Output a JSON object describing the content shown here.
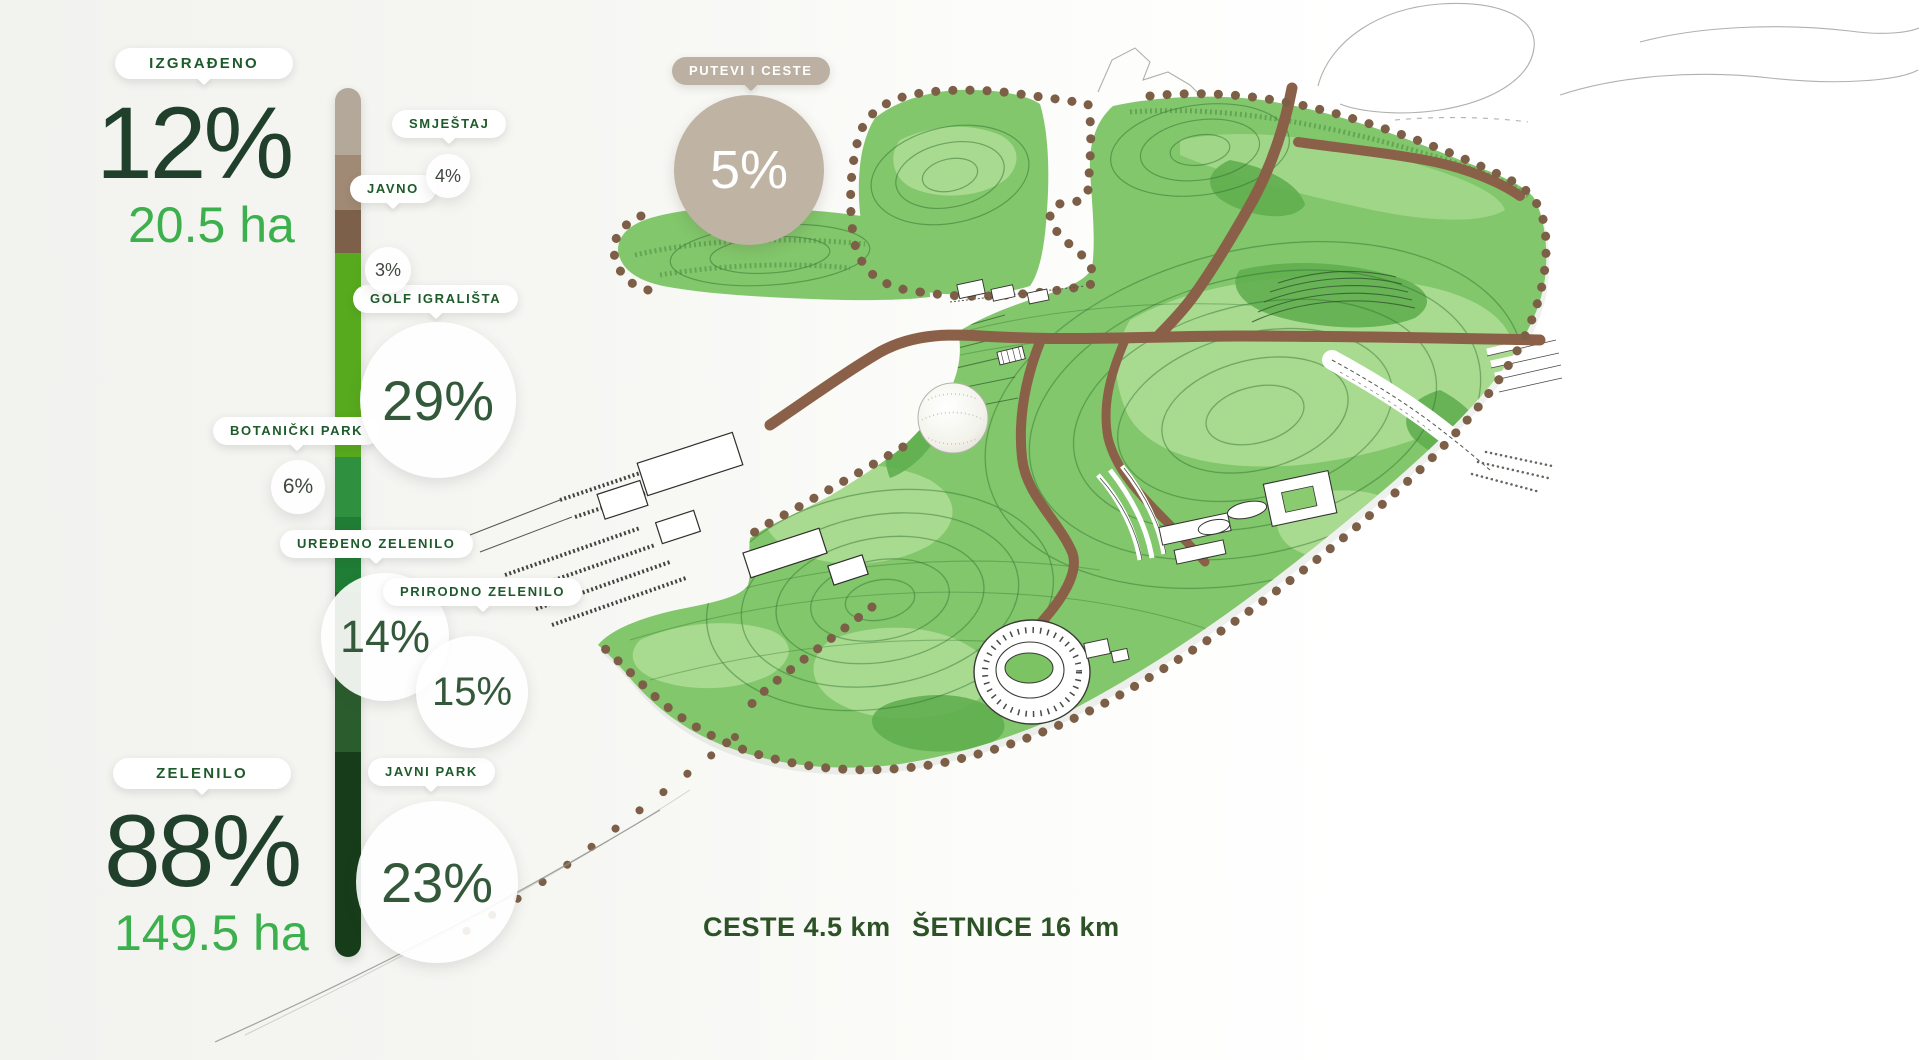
{
  "panel": {
    "built": {
      "label": "IZGRAĐENO",
      "percent": "12%",
      "area": "20.5 ha"
    },
    "green": {
      "label": "ZELENILO",
      "percent": "88%",
      "area": "149.5 ha"
    },
    "accent_green_text": "#3bb04c",
    "dark_green_text": "#20402c",
    "pill_text_color": "#1e5b2a",
    "callouts": {
      "putevi": {
        "label": "PUTEVI I CESTE",
        "percent": "5%",
        "color": "#bfb3a4"
      },
      "smjestaj": {
        "label": "SMJEŠTAJ",
        "percent": "4%",
        "color": "#a18a75"
      },
      "javno": {
        "label": "JAVNO",
        "percent": "3%",
        "color": "#7c6049"
      },
      "golf": {
        "label": "GOLF IGRALIŠTA",
        "percent": "29%",
        "color": "#57aa1d"
      },
      "botanicki": {
        "label": "BOTANIČKI PARK",
        "percent": "6%",
        "color": "#2f9040"
      },
      "uredeno": {
        "label": "UREĐENO ZELENILO",
        "percent": "14%",
        "color": "#1f7d35"
      },
      "prirodno": {
        "label": "PRIRODNO ZELENILO",
        "percent": "15%",
        "color": "#2a5c2d"
      },
      "javni_park": {
        "label": "JAVNI PARK",
        "percent": "23%",
        "color": "#173c19"
      }
    }
  },
  "bar": {
    "segments": [
      {
        "name": "putevi-i-ceste",
        "percent": "5%",
        "color": "#b4a89a"
      },
      {
        "name": "smjestaj",
        "percent": "4%",
        "color": "#a18a75"
      },
      {
        "name": "javno",
        "percent": "3%",
        "color": "#7c6049"
      },
      {
        "name": "golf-igralista",
        "percent": "29%",
        "color": "#57aa1d"
      },
      {
        "name": "botanicki-park",
        "percent": "6%",
        "color": "#2f9040"
      },
      {
        "name": "uredeno-zelenilo",
        "percent": "14%",
        "color": "#1f7d35"
      },
      {
        "name": "prirodno-zelenilo",
        "percent": "15%",
        "color": "#2a5c2d"
      },
      {
        "name": "javni-park",
        "percent": "23%",
        "color": "#173c19"
      }
    ]
  },
  "footer": {
    "ceste": "CESTE 4.5 km",
    "setnice": "ŠETNICE 16 km"
  },
  "map_colors": {
    "terrain_base": "#82c76b",
    "terrain_light": "#a8da8f",
    "terrain_dark": "#5fae4f",
    "contour": "#2e6e31",
    "road_brown": "#8a6148",
    "boundary_dot_brown": "#7d5f48"
  },
  "chart_data": {
    "type": "bar",
    "title": "Park land use share (stacked bar)",
    "categories": [
      "PUTEVI I CESTE",
      "SMJEŠTAJ",
      "JAVNO",
      "GOLF IGRALIŠTA",
      "BOTANIČKI PARK",
      "UREĐENO ZELENILO",
      "PRIRODNO ZELENILO",
      "JAVNI PARK"
    ],
    "values": [
      5,
      4,
      3,
      29,
      6,
      14,
      15,
      23
    ],
    "groups": [
      {
        "name": "IZGRAĐENO",
        "percent": 12,
        "area_ha": 20.5
      },
      {
        "name": "ZELENILO",
        "percent": 88,
        "area_ha": 149.5
      }
    ],
    "roads_km": 4.5,
    "footpaths_km": 16,
    "legend_position": "left",
    "grid": false
  }
}
